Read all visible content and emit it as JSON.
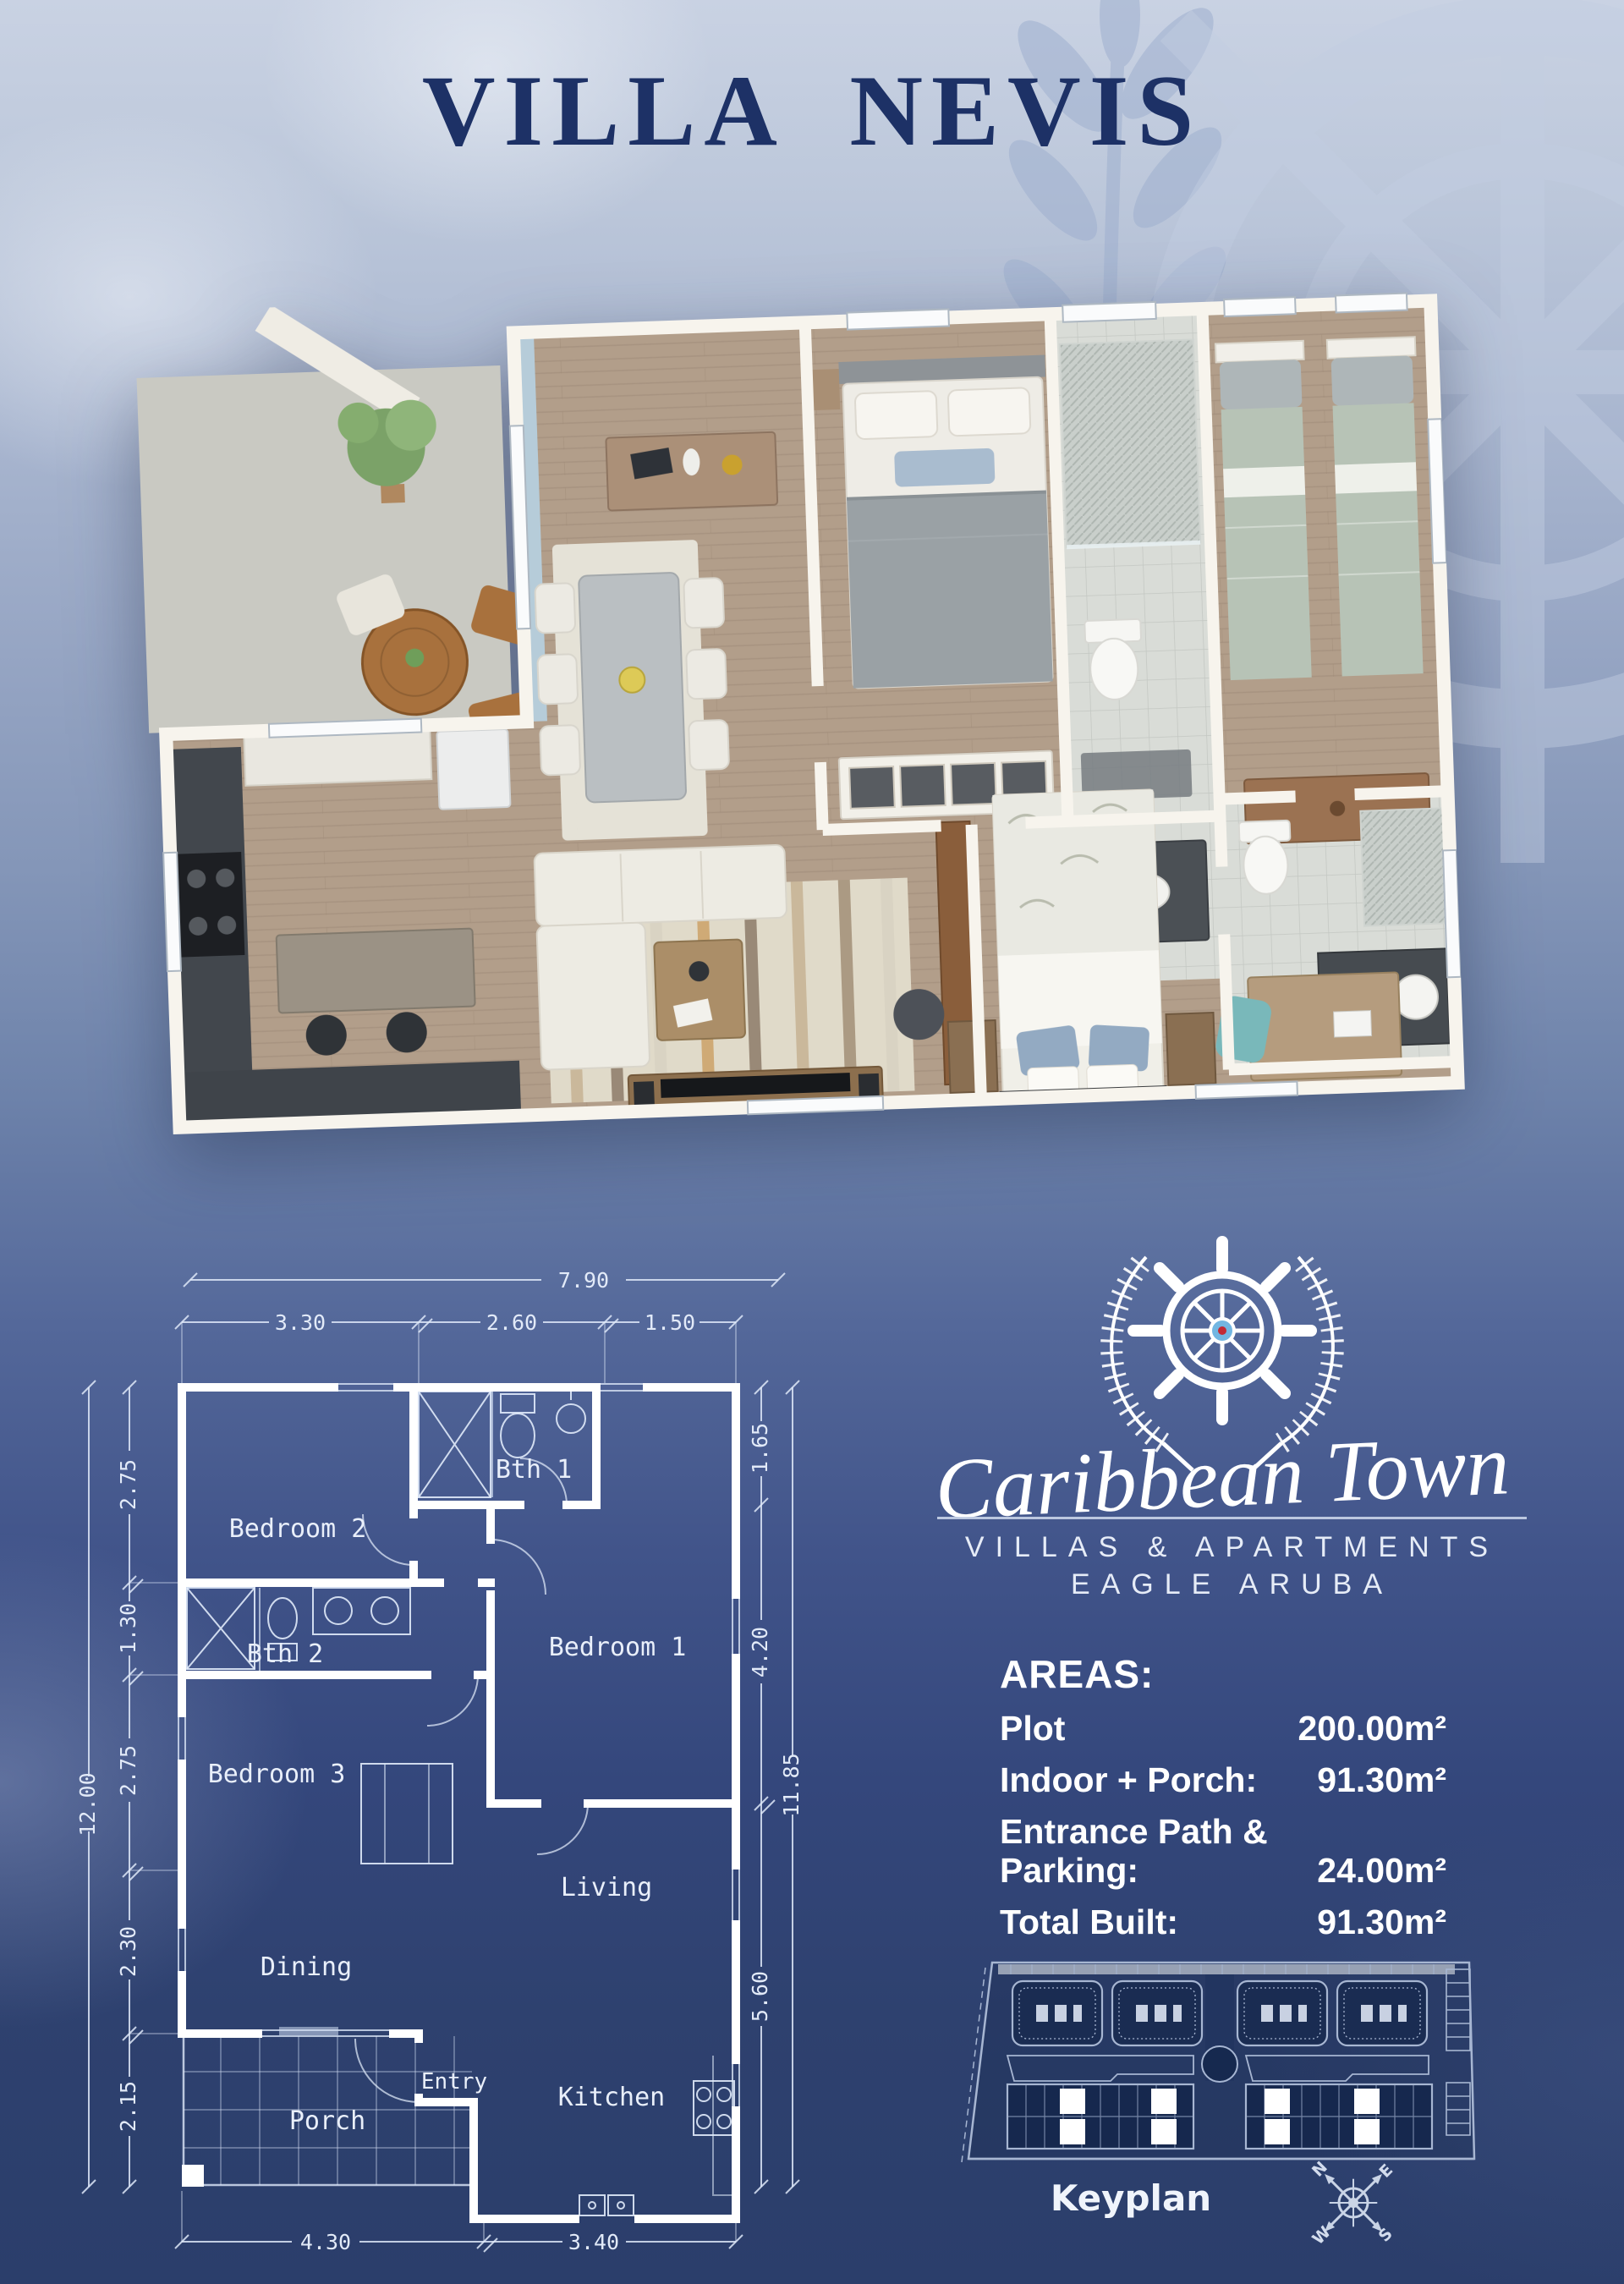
{
  "page": {
    "title": "VILLA NEVIS"
  },
  "brand": {
    "name": "Caribbean Town",
    "tagline_line1": "VILLAS & APARTMENTS",
    "tagline_line2": "EAGLE ARUBA"
  },
  "areas": {
    "heading": "AREAS:",
    "rows": [
      {
        "label": "Plot",
        "value": "200.00m²"
      },
      {
        "label": "Indoor + Porch:",
        "value": "91.30m²"
      },
      {
        "label": "Entrance Path & Parking:",
        "value": "24.00m²"
      },
      {
        "label": "Total Built:",
        "value": "91.30m²"
      }
    ]
  },
  "blueprint": {
    "rooms": [
      "Bedroom 2",
      "Bth 1",
      "Bedroom 1",
      "Bth 2",
      "Bedroom 3",
      "Dining",
      "Living",
      "Entry",
      "Kitchen",
      "Porch"
    ],
    "dims": {
      "top_total": "7.90",
      "top_segments": [
        "3.30",
        "2.60",
        "1.50"
      ],
      "left_total": "12.00",
      "left_segments": [
        "2.75",
        "1.30",
        "2.75",
        "2.30",
        "2.15"
      ],
      "right_total": "11.85",
      "right_segments": [
        "1.65",
        "4.20",
        "5.60"
      ],
      "bottom_segments": [
        "4.30",
        "3.40"
      ]
    }
  },
  "keyplan": {
    "label": "Keyplan"
  },
  "compass": {
    "n": "N",
    "e": "E",
    "s": "S",
    "w": "W"
  },
  "icons": {
    "logo": "ship-wheel-with-laurel-wreath",
    "watermark": "ship-wheel",
    "compass": "compass-rose"
  },
  "colors": {
    "title_navy": "#1d3166",
    "page_bottom_navy": "#2b3e6b",
    "blueprint_line": "#e2eaf8",
    "logo_hub_blue": "#72b6e2",
    "logo_hub_red": "#c22a35",
    "text_white": "#ffffff"
  }
}
